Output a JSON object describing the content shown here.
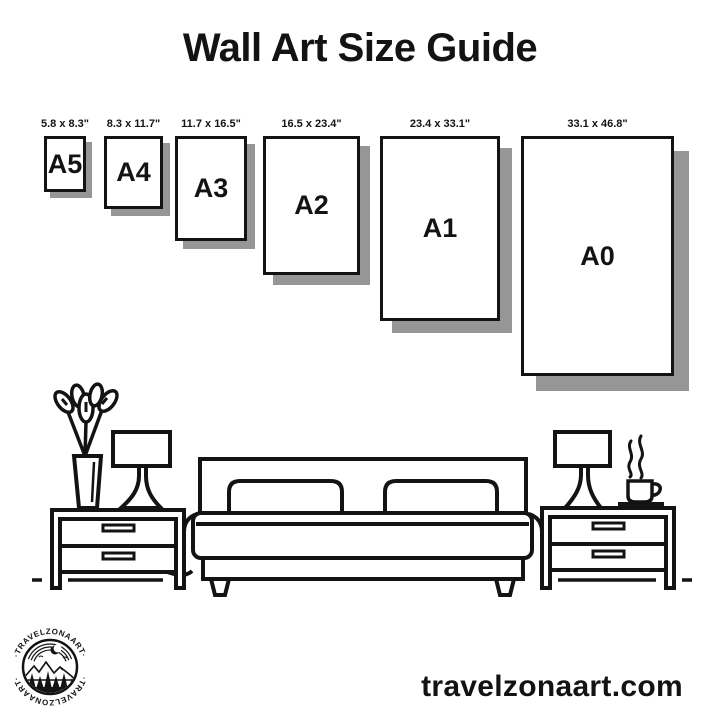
{
  "title": "Wall Art Size Guide",
  "size_guide": {
    "sizes": [
      {
        "name": "A5",
        "dimensions": "5.8 x 8.3\"",
        "x": 44,
        "w": 42,
        "h": 56
      },
      {
        "name": "A4",
        "dimensions": "8.3 x 11.7\"",
        "x": 104,
        "w": 59,
        "h": 73
      },
      {
        "name": "A3",
        "dimensions": "11.7 x 16.5\"",
        "x": 175,
        "w": 72,
        "h": 105
      },
      {
        "name": "A2",
        "dimensions": "16.5 x 23.4\"",
        "x": 263,
        "w": 97,
        "h": 139
      },
      {
        "name": "A1",
        "dimensions": "23.4 x 33.1\"",
        "x": 380,
        "w": 120,
        "h": 185
      },
      {
        "name": "A0",
        "dimensions": "33.1 x 46.8\"",
        "x": 521,
        "w": 153,
        "h": 240
      }
    ]
  },
  "illustration_elements": [
    "vase-with-leaves",
    "table-lamp",
    "nightstand",
    "double-bed-with-pillows",
    "nightstand",
    "table-lamp",
    "steaming-coffee-cup"
  ],
  "brand": {
    "logo_text_top": "·TRAVELZONAART·",
    "logo_text_bottom": "·TRAVELZONAART·",
    "website": "travelzonaart.com"
  },
  "colors": {
    "ink": "#131313",
    "shadow": "#969696",
    "background": "#ffffff"
  }
}
